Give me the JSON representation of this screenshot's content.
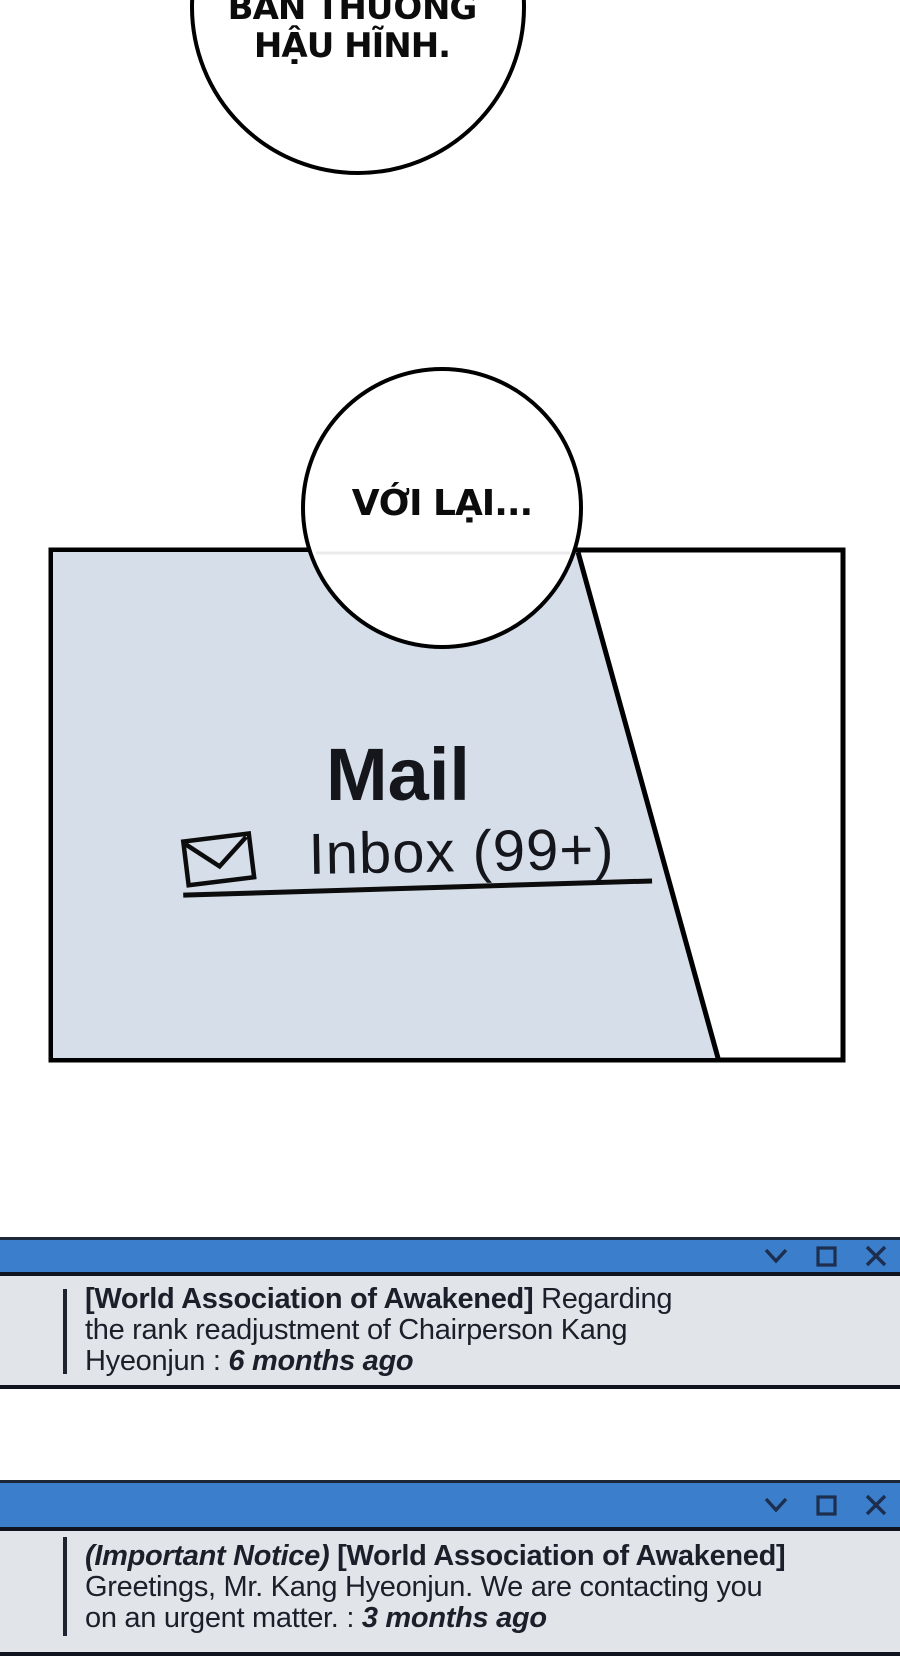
{
  "comic": {
    "bubble_top": {
      "line1": "BẢN THƯỞNG",
      "line2": "HẬU HĨNH."
    },
    "bubble_mid": {
      "text": "VỚI LẠI..."
    },
    "mail_panel": {
      "app_title": "Mail",
      "inbox_label": "Inbox (99+)",
      "unread_count": "99+",
      "envelope_icon": "envelope-icon",
      "panel_tint": "#d5dee9"
    }
  },
  "colors": {
    "titlebar_blue": "#3b7ecb",
    "window_body_bg": "#e1e5ea",
    "dark_line": "#10141f",
    "icon_navy": "#1d2e4e",
    "message_text": "#1b1f29"
  },
  "windows": [
    {
      "controls": [
        {
          "icon": "chevron-down-icon",
          "glyph": "∨"
        },
        {
          "icon": "maximize-icon",
          "glyph": "□"
        },
        {
          "icon": "close-icon",
          "glyph": "✕"
        }
      ],
      "lines": [
        [
          {
            "t": "[World Association of Awakened]",
            "s": "b"
          },
          {
            "t": " Regarding",
            "s": "r"
          }
        ],
        [
          {
            "t": "the rank readjustment of Chairperson Kang",
            "s": "r"
          }
        ],
        [
          {
            "t": "Hyeonjun : ",
            "s": "r"
          },
          {
            "t": "6 months ago",
            "s": "bi"
          }
        ]
      ]
    },
    {
      "controls": [
        {
          "icon": "chevron-down-icon",
          "glyph": "∨"
        },
        {
          "icon": "maximize-icon",
          "glyph": "□"
        },
        {
          "icon": "close-icon",
          "glyph": "✕"
        }
      ],
      "lines": [
        [
          {
            "t": "(Important Notice)",
            "s": "bi"
          },
          {
            "t": " ",
            "s": "r"
          },
          {
            "t": "[World Association of Awakened]",
            "s": "b"
          }
        ],
        [
          {
            "t": "Greetings, Mr. Kang Hyeonjun. We are contacting you",
            "s": "r"
          }
        ],
        [
          {
            "t": "on an urgent matter. : ",
            "s": "r"
          },
          {
            "t": "3 months ago",
            "s": "bi"
          }
        ]
      ]
    }
  ]
}
